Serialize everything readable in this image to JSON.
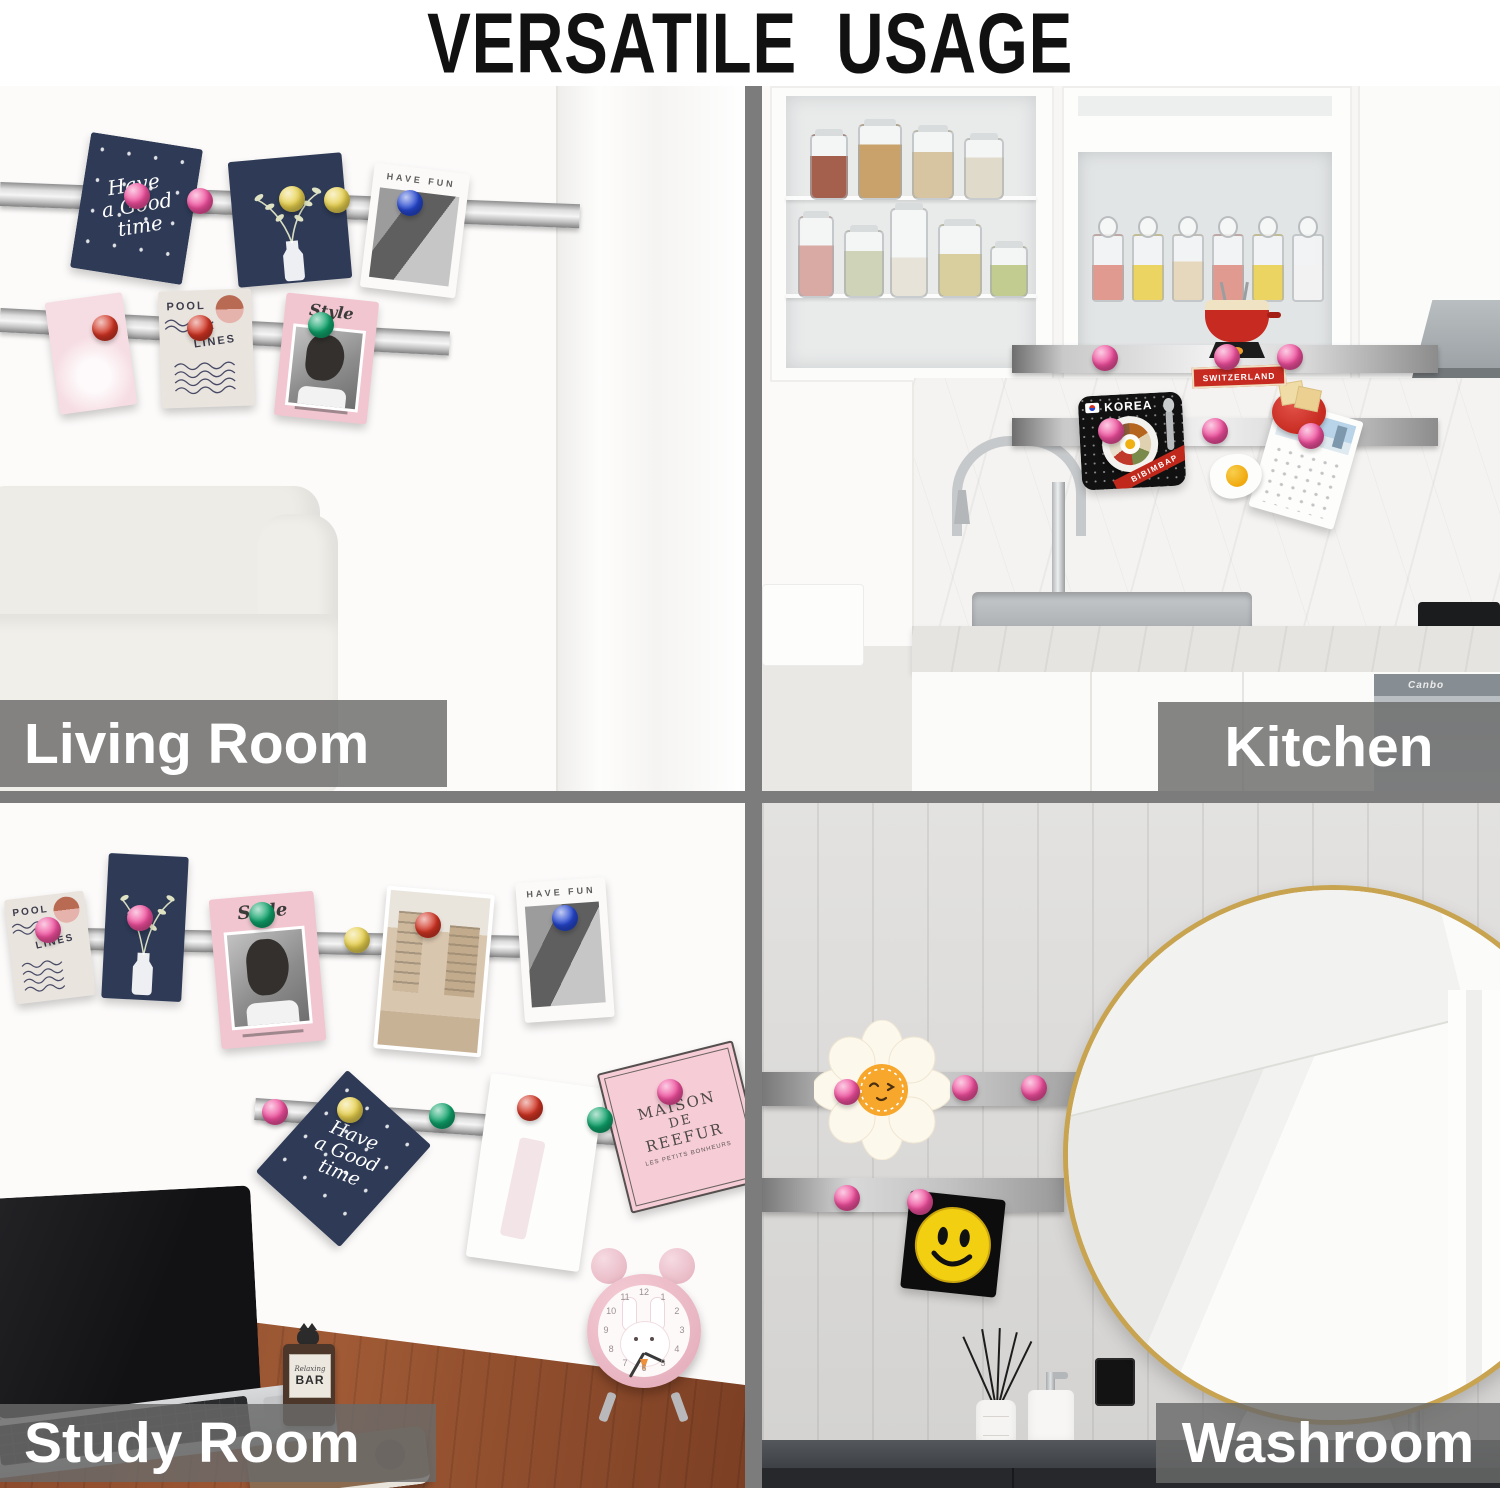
{
  "title": "VERSATILE USAGE",
  "scenes": {
    "living_room": {
      "label": "Living Room"
    },
    "kitchen": {
      "label": "Kitchen"
    },
    "study_room": {
      "label": "Study Room"
    },
    "washroom": {
      "label": "Washroom"
    }
  },
  "cards": {
    "good_time_1": "Have",
    "good_time_2": "a Good",
    "good_time_3": "time",
    "have_fun": "HAVE FUN",
    "pool": "POOL",
    "lines": "LINES",
    "style": "Style",
    "maison_1": "MAISON",
    "maison_2": "DE",
    "maison_3": "REEFUR",
    "maison_sub": "LES PETITS BONHEURS",
    "korea": "KOREA",
    "bibimbap": "BIBIMBAP",
    "switzerland": "SWITZERLAND"
  },
  "props": {
    "sign_1": "Relaxing",
    "sign_2": "BAR",
    "appliance_brand": "Canbo",
    "clock_numerals": [
      "12",
      "1",
      "2",
      "3",
      "4",
      "5",
      "6",
      "7",
      "8",
      "9",
      "10",
      "11"
    ]
  },
  "colors": {
    "divider": "#7c7c7c",
    "label_bar": "rgba(106,106,106,0.82)",
    "label_text": "#ffffff",
    "magnet_pink": "#f04f9d",
    "magnet_red": "#d23524",
    "magnet_yellow": "#e8d14f",
    "magnet_green": "#0fa36b",
    "magnet_blue": "#2547d0",
    "navy_card": "#2e3a56",
    "pink_card": "#f2c7d1",
    "mirror_gold": "#c8a350",
    "desk_wood": "#94512f"
  }
}
